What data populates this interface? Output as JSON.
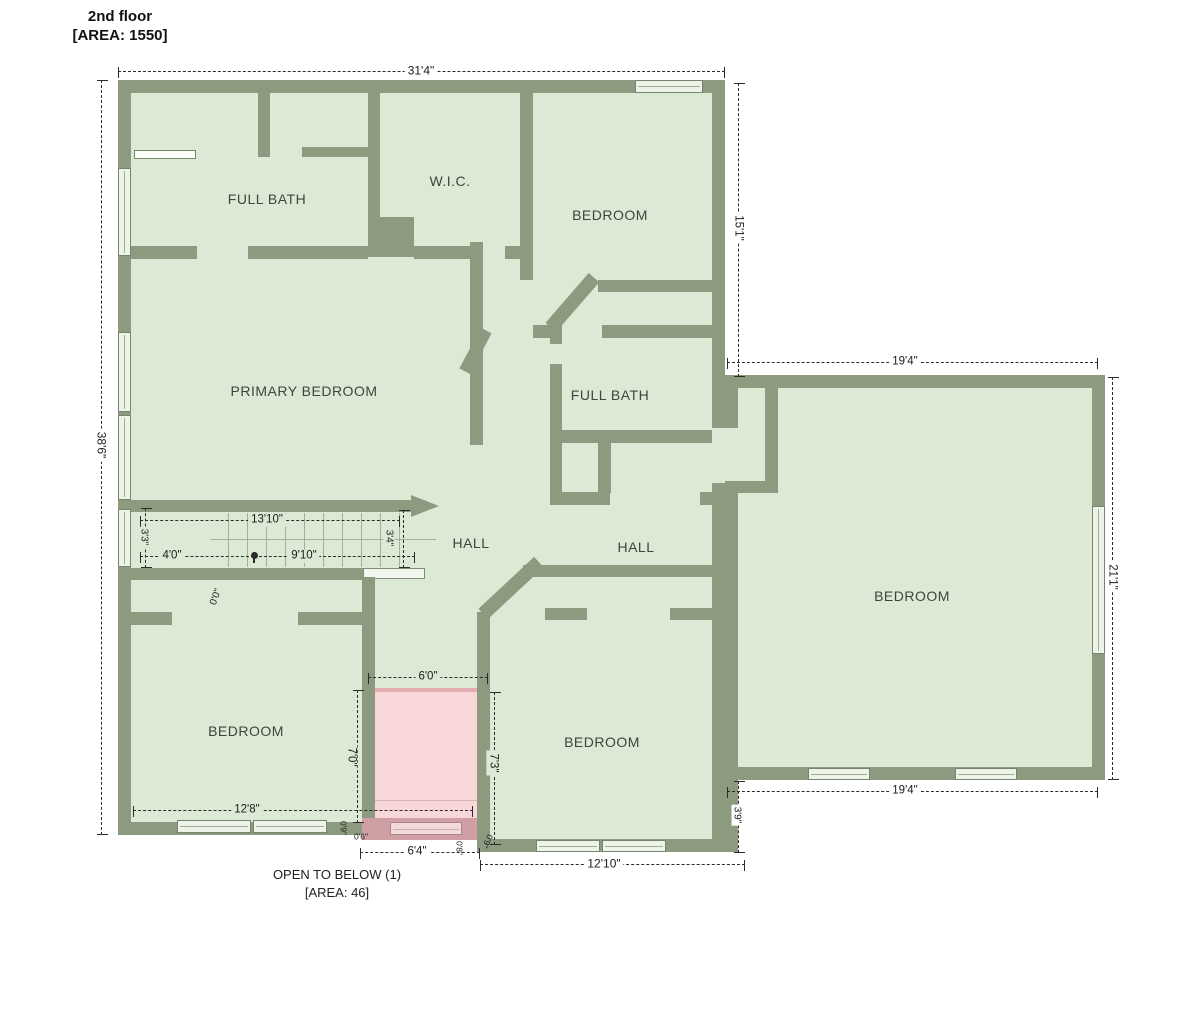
{
  "title": {
    "name": "2nd floor",
    "area": "[AREA: 1550]"
  },
  "note": {
    "line1": "OPEN TO BELOW (1)",
    "line2": "[AREA: 46]"
  },
  "rooms": {
    "full_bath_upper": "FULL BATH",
    "wic": "W.I.C.",
    "bedroom_top": "BEDROOM",
    "primary_bedroom": "PRIMARY BEDROOM",
    "full_bath_mid": "FULL BATH",
    "hall_left": "HALL",
    "hall_right": "HALL",
    "bedroom_left": "BEDROOM",
    "bedroom_mid": "BEDROOM",
    "bedroom_right": "BEDROOM"
  },
  "dims": {
    "overall_width": "31'4\"",
    "overall_height": "38'6\"",
    "bedroom_top_height": "15'1\"",
    "right_width_top": "19'4\"",
    "right_height": "21'1\"",
    "right_width_bottom": "19'4\"",
    "right_offset": "3'9\"",
    "stairs_len": "13'10\"",
    "stairs_width": "3'3\"",
    "stairs_run_a": "4'0\"",
    "stairs_run_b": "9'10\"",
    "stairs_end": "3'4\"",
    "landing": "0'0\"",
    "bedroom_left_width": "12'8\"",
    "open_height_left": "7'0\"",
    "open_width_top": "6'0\"",
    "open_height_right": "7'3\"",
    "open_width_bottom": "6'4\"",
    "open_seg_a": "0'9\"",
    "open_seg_b": "0'6\"",
    "open_seg_c": "0'8\"",
    "open_seg_d": "0'9\"",
    "bedroom_mid_width": "12'10\""
  },
  "colors": {
    "wall": "#8c9b80",
    "floor": "#dce9d4",
    "window": "#eef3e9",
    "open-fill": "#f8d7da",
    "open-band": "#cf9fa3",
    "dim": "#2b2b2b",
    "label": "#3c463e"
  }
}
